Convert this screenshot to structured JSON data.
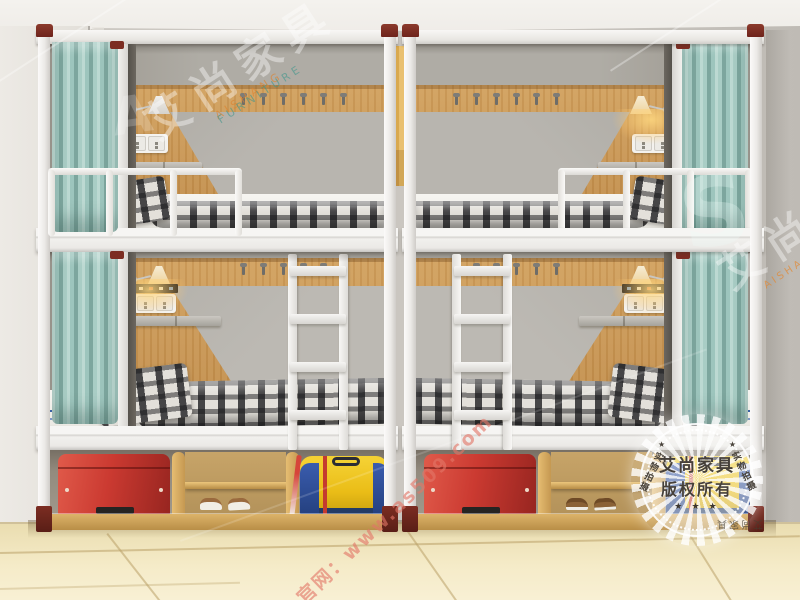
{
  "watermarks": {
    "brand_top": {
      "text": "艾尚家具",
      "sub_line1": "AISHANG",
      "sub_line2": "FURNITURE"
    },
    "brand_right": {
      "text": "艾尚家具",
      "sub": "AISHANG FURNITURE"
    },
    "monogram_left": "A",
    "monogram_right": "S",
    "website": {
      "text": "官网：www.as509.com",
      "color": "#e1766a"
    },
    "stamp": {
      "title": "艾尚家具",
      "subtitle": "版权所有",
      "stars": "★ ★ ★",
      "star_left": "★",
      "star_right": "★",
      "side_left": "实物拍摄",
      "side_right": "实物拍摄",
      "bottom_text": "艾尚家具"
    }
  },
  "scene": {
    "description": "Two white-metal dormitory bunk beds with teal privacy curtains, wood headboard panels, reading lamps, power outlets, plaid bedding, ladders and under-bed storage cubbies on a beige tiled floor.",
    "colors": {
      "curtain_teal": "#93bdb5",
      "wood_panel": "#c89552",
      "metal_frame": "#f2f1ee",
      "accent_caps_maroon": "#772a22",
      "wall_gray": "#c9c5bf",
      "floor_tile": "#f0e2b6",
      "suitcase_red": "#cb3a31",
      "bag_yellow": "#efc41e",
      "bag_blue": "#2c4d9b",
      "pillow_orange": "#e2a23b"
    },
    "objects": [
      "bunk-bed-frame",
      "privacy-curtain",
      "wall-lamp",
      "power-outlet",
      "control-panel",
      "coat-hooks",
      "wall-shelf",
      "guardrail",
      "ladder",
      "mattress",
      "plaid-blanket",
      "plaid-pillow",
      "orange-pillow",
      "hanging-cabinet",
      "storage-cubby",
      "red-suitcase",
      "slippers",
      "duffel-bag",
      "tiled-floor"
    ]
  }
}
